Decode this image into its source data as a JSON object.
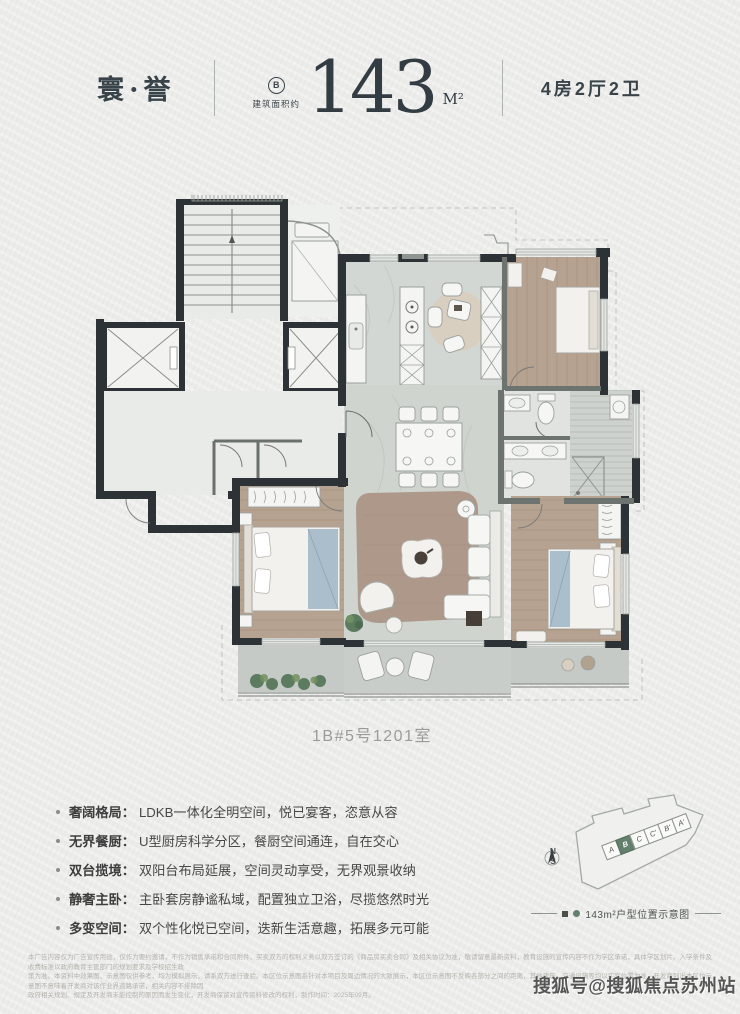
{
  "header": {
    "brand": "寰·誉",
    "unit_badge": "B",
    "area_label": "建筑面积约",
    "area_value": "143",
    "area_unit": "M²",
    "rooms": "4房2厅2卫"
  },
  "floorplan": {
    "caption": "1B#5号1201室"
  },
  "features": [
    {
      "title": "奢阔格局：",
      "desc": "LDKB一体化全明空间，悦已宴客，恣意从容"
    },
    {
      "title": "无界餐厨：",
      "desc": "U型厨房科学分区，餐厨空间通连，自在交心"
    },
    {
      "title": "双台揽境：",
      "desc": "双阳台布局延展，空间灵动享受，无界观景收纳"
    },
    {
      "title": "静奢主卧：",
      "desc": "主卧套房静谧私域，配置独立卫浴，尽揽悠然时光"
    },
    {
      "title": "多变空间：",
      "desc": "双个性化悦已空间，迭新生活意趣，拓展多元可能"
    }
  ],
  "diagram": {
    "cells": [
      "A",
      "B",
      "C",
      "C'",
      "B'",
      "A'"
    ],
    "highlight": "B",
    "compass_n": "N",
    "compass_s": "S",
    "caption": "143m²户型位置示意图"
  },
  "colors": {
    "accent_green": "#64806c",
    "wall": "#2d3236",
    "paper": "#ecedeb"
  },
  "disclaimer": {
    "line1": "本广告内容仅为广告宣传用途，仅作为要约邀请，不作为销售承诺和合同附件，买卖双方的权利义务以双方签订的《商品房买卖合同》及相关协议为准，敬请留意最新资料，教育设施的宣传内容不作为学区承诺，具体学区划片、入学条件及收费标准以政府教育主管部门的规划要求及学校招生政",
    "line2": "策为准。本资料中效果图、示意图仅供参考，均为模拟展示，请系双方进行查验。本区位示意图系针对本项目及周边情况的大致展示，本区位示意图不反映各部分之间的距离，其他建筑、交通设施等均以实际位置为准，开发商列出本区位示意图不意味着开发商对该作业界道路承诺，相关内容不排除因",
    "line3": "政府相关规划、规定及开发商未能控制的原因而发生变化，开发商保留对宣传资料修改的权利，制作时间：2025年09月。"
  },
  "watermark": "搜狐号@搜狐焦点苏州站"
}
